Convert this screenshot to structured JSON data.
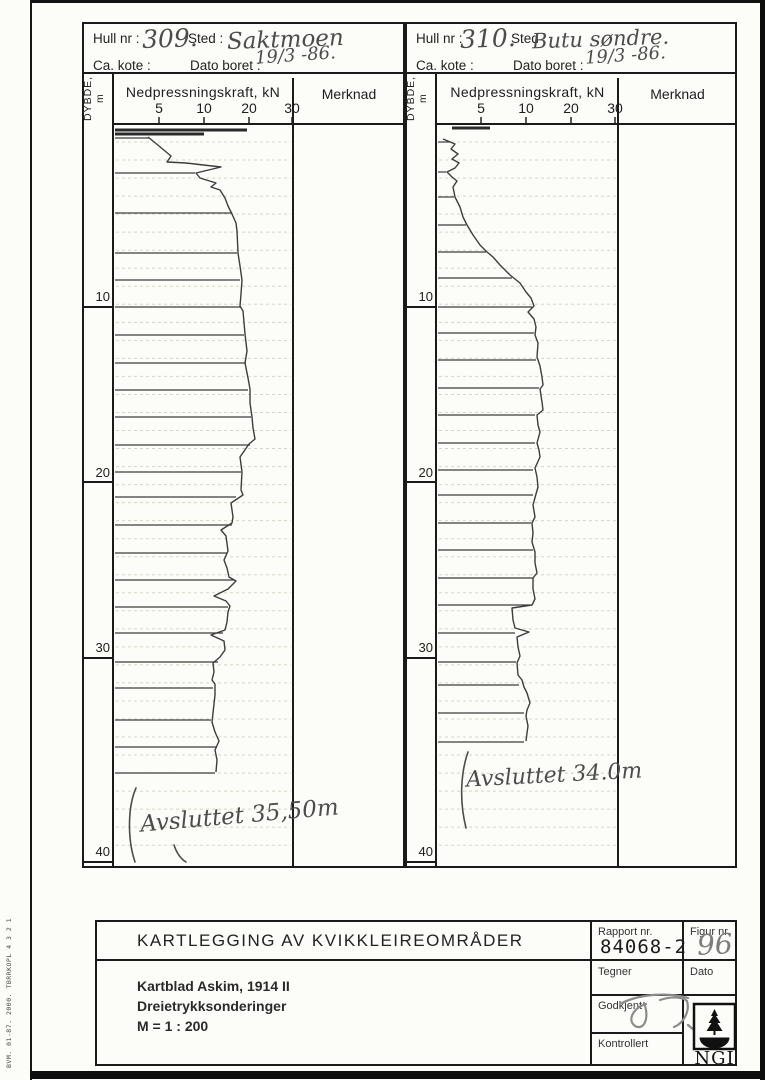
{
  "page": {
    "sidebar_text": "BVM. 01-87. 2000. TBRRKOPL 4 3 2 1"
  },
  "logs": [
    {
      "header": {
        "hull_label": "Hull nr :",
        "hull_value": "309.",
        "sted_label": "Sted :",
        "sted_value": "Saktmoen",
        "kote_label": "Ca. kote :",
        "kote_value": "",
        "dato_label": "Dato boret :",
        "dato_value": "19/3 -86."
      },
      "axis": {
        "depth_label": "DYBDE, m",
        "force_label": "Nedpressningskraft, kN",
        "merknad_label": "Merknad",
        "ticks": [
          {
            "label": "5",
            "x": 159
          },
          {
            "label": "10",
            "x": 204
          },
          {
            "label": "20",
            "x": 249
          },
          {
            "label": "30",
            "x": 292
          }
        ],
        "depth_marks": [
          {
            "label": "10",
            "y": 296,
            "line_y": 307
          },
          {
            "label": "20",
            "y": 472,
            "line_y": 482
          },
          {
            "label": "30",
            "y": 647,
            "line_y": 658
          },
          {
            "label": "40",
            "y": 851,
            "line_y": 862
          }
        ]
      },
      "annotation": "Avsluttet 35,50m",
      "chart": {
        "x0": 114,
        "x1": 291,
        "top": 124,
        "bottom": 866,
        "grid_step": 18.03,
        "depth_col_x0": 84,
        "depth_label_x": 110,
        "tick_text_y": 113
      },
      "trace": [
        [
          148,
          137
        ],
        [
          159,
          146
        ],
        [
          171,
          156
        ],
        [
          167,
          162
        ],
        [
          186,
          163
        ],
        [
          221,
          167
        ],
        [
          196,
          173
        ],
        [
          200,
          178
        ],
        [
          216,
          183
        ],
        [
          211,
          187
        ],
        [
          220,
          190
        ],
        [
          225,
          198
        ],
        [
          228,
          206
        ],
        [
          232,
          214
        ],
        [
          236,
          223
        ],
        [
          237,
          231
        ],
        [
          238,
          253
        ],
        [
          240,
          266
        ],
        [
          242,
          280
        ],
        [
          241,
          294
        ],
        [
          240,
          306
        ],
        [
          243,
          311
        ],
        [
          245,
          334
        ],
        [
          247,
          351
        ],
        [
          245,
          363
        ],
        [
          248,
          378
        ],
        [
          250,
          389
        ],
        [
          250,
          403
        ],
        [
          252,
          417
        ],
        [
          253,
          428
        ],
        [
          255,
          439
        ],
        [
          249,
          444
        ],
        [
          240,
          457
        ],
        [
          242,
          472
        ],
        [
          241,
          490
        ],
        [
          243,
          495
        ],
        [
          231,
          503
        ],
        [
          233,
          517
        ],
        [
          232,
          523
        ],
        [
          221,
          530
        ],
        [
          226,
          536
        ],
        [
          228,
          551
        ],
        [
          224,
          560
        ],
        [
          227,
          568
        ],
        [
          229,
          577
        ],
        [
          236,
          581
        ],
        [
          228,
          589
        ],
        [
          214,
          596
        ],
        [
          226,
          601
        ],
        [
          230,
          606
        ],
        [
          228,
          612
        ],
        [
          227,
          622
        ],
        [
          225,
          630
        ],
        [
          211,
          635
        ],
        [
          224,
          641
        ],
        [
          225,
          650
        ],
        [
          220,
          657
        ],
        [
          213,
          663
        ],
        [
          214,
          672
        ],
        [
          212,
          680
        ],
        [
          215,
          684
        ],
        [
          215,
          695
        ],
        [
          213,
          713
        ],
        [
          212,
          722
        ],
        [
          215,
          732
        ],
        [
          219,
          741
        ],
        [
          215,
          750
        ],
        [
          217,
          760
        ],
        [
          216,
          772
        ]
      ],
      "returns": [
        [
          138,
          149
        ],
        [
          173,
          195
        ],
        [
          213,
          231
        ],
        [
          253,
          237
        ],
        [
          280,
          240
        ],
        [
          307,
          241
        ],
        [
          335,
          244
        ],
        [
          363,
          246
        ],
        [
          390,
          248
        ],
        [
          417,
          251
        ],
        [
          445,
          250
        ],
        [
          472,
          241
        ],
        [
          497,
          236
        ],
        [
          525,
          232
        ],
        [
          553,
          227
        ],
        [
          580,
          234
        ],
        [
          607,
          228
        ],
        [
          633,
          223
        ],
        [
          662,
          218
        ],
        [
          688,
          213
        ],
        [
          720,
          211
        ],
        [
          747,
          217
        ],
        [
          773,
          215
        ]
      ],
      "top_marks": [
        [
          130,
          115,
          247
        ],
        [
          134,
          115,
          204
        ]
      ],
      "strokes": [
        "M136 788 C128 806 127 838 135 862",
        "M174 845 c3 9 7 14 12 17"
      ]
    },
    {
      "header": {
        "hull_label": "Hull nr :",
        "hull_value": "310.",
        "sted_label": "Sted",
        "sted_value": "Butu søndre.",
        "kote_label": "Ca. kote :",
        "kote_value": "",
        "dato_label": "Dato boret :",
        "dato_value": "19/3 -86."
      },
      "axis": {
        "depth_label": "DYBDE, m",
        "force_label": "Nedpressningskraft, kN",
        "merknad_label": "Merknad",
        "ticks": [
          {
            "label": "5",
            "x": 481
          },
          {
            "label": "10",
            "x": 526
          },
          {
            "label": "20",
            "x": 571
          },
          {
            "label": "30",
            "x": 615
          }
        ],
        "depth_marks": [
          {
            "label": "10",
            "y": 296,
            "line_y": 307
          },
          {
            "label": "20",
            "y": 472,
            "line_y": 482
          },
          {
            "label": "30",
            "y": 647,
            "line_y": 658
          },
          {
            "label": "40",
            "y": 851,
            "line_y": 862
          }
        ]
      },
      "annotation": "Avsluttet 34.0m",
      "chart": {
        "x0": 437,
        "x1": 616,
        "top": 124,
        "bottom": 866,
        "grid_step": 18.03,
        "depth_col_x0": 407,
        "depth_label_x": 433,
        "tick_text_y": 113
      },
      "trace": [
        [
          443,
          139
        ],
        [
          455,
          144
        ],
        [
          451,
          149
        ],
        [
          458,
          154
        ],
        [
          452,
          159
        ],
        [
          459,
          163
        ],
        [
          455,
          168
        ],
        [
          447,
          172
        ],
        [
          452,
          177
        ],
        [
          457,
          181
        ],
        [
          453,
          187
        ],
        [
          455,
          197
        ],
        [
          460,
          207
        ],
        [
          463,
          217
        ],
        [
          467,
          225
        ],
        [
          473,
          235
        ],
        [
          480,
          245
        ],
        [
          487,
          252
        ],
        [
          493,
          257
        ],
        [
          500,
          265
        ],
        [
          510,
          275
        ],
        [
          520,
          283
        ],
        [
          526,
          292
        ],
        [
          531,
          298
        ],
        [
          534,
          306
        ],
        [
          528,
          312
        ],
        [
          534,
          319
        ],
        [
          536,
          327
        ],
        [
          535,
          335
        ],
        [
          538,
          343
        ],
        [
          537,
          357
        ],
        [
          540,
          366
        ],
        [
          542,
          377
        ],
        [
          543,
          385
        ],
        [
          540,
          389
        ],
        [
          542,
          402
        ],
        [
          543,
          410
        ],
        [
          537,
          415
        ],
        [
          538,
          425
        ],
        [
          540,
          432
        ],
        [
          537,
          443
        ],
        [
          539,
          450
        ],
        [
          540,
          457
        ],
        [
          535,
          468
        ],
        [
          537,
          477
        ],
        [
          538,
          487
        ],
        [
          536,
          494
        ],
        [
          533,
          505
        ],
        [
          535,
          517
        ],
        [
          532,
          523
        ],
        [
          533,
          533
        ],
        [
          532,
          542
        ],
        [
          535,
          552
        ],
        [
          535,
          563
        ],
        [
          537,
          573
        ],
        [
          533,
          578
        ],
        [
          533,
          589
        ],
        [
          535,
          599
        ],
        [
          532,
          605
        ],
        [
          512,
          608
        ],
        [
          513,
          620
        ],
        [
          515,
          628
        ],
        [
          529,
          632
        ],
        [
          517,
          637
        ],
        [
          518,
          647
        ],
        [
          520,
          656
        ],
        [
          517,
          663
        ],
        [
          518,
          675
        ],
        [
          522,
          680
        ],
        [
          524,
          687
        ],
        [
          527,
          693
        ],
        [
          530,
          703
        ],
        [
          527,
          710
        ],
        [
          526,
          716
        ],
        [
          528,
          726
        ],
        [
          527,
          733
        ],
        [
          526,
          741
        ]
      ],
      "returns": [
        [
          142,
          450
        ],
        [
          172,
          446
        ],
        [
          197,
          454
        ],
        [
          225,
          466
        ],
        [
          252,
          486
        ],
        [
          278,
          512
        ],
        [
          307,
          532
        ],
        [
          333,
          534
        ],
        [
          360,
          536
        ],
        [
          388,
          539
        ],
        [
          415,
          535
        ],
        [
          443,
          535
        ],
        [
          470,
          533
        ],
        [
          495,
          533
        ],
        [
          523,
          531
        ],
        [
          550,
          533
        ],
        [
          578,
          533
        ],
        [
          605,
          530
        ],
        [
          633,
          515
        ],
        [
          662,
          516
        ],
        [
          685,
          519
        ],
        [
          713,
          524
        ],
        [
          742,
          524
        ]
      ],
      "top_marks": [
        [
          128,
          452,
          490
        ]
      ],
      "strokes": [
        "M468 752 C461 772 459 800 466 828"
      ]
    }
  ],
  "titleblock": {
    "title": "KARTLEGGING AV KVIKKLEIREOMRÅDER",
    "lines": [
      "Kartblad Askim, 1914 II",
      "Dreietrykksonderinger",
      "M = 1 : 200"
    ],
    "rapport_label": "Rapport nr.",
    "rapport_value": "84068-2",
    "figur_label": "Figur nr.",
    "figur_value": "96",
    "tegner_label": "Tegner",
    "dato_label": "Dato",
    "godkjent_label": "Godkjent",
    "kontrollert_label": "Kontrollert",
    "logo_text": "NGI",
    "godkjent_stroke1": "M10 15 C28 6 56 4 76 10",
    "godkjent_stroke2": "M34 16 C21 20 15 32 23 38 C32 43 38 30 32 15",
    "godkjent_stroke3": "M48 12 C60 8 71 9 75 13 C78 23 72 35 62 39 M76 37 l6 5"
  }
}
